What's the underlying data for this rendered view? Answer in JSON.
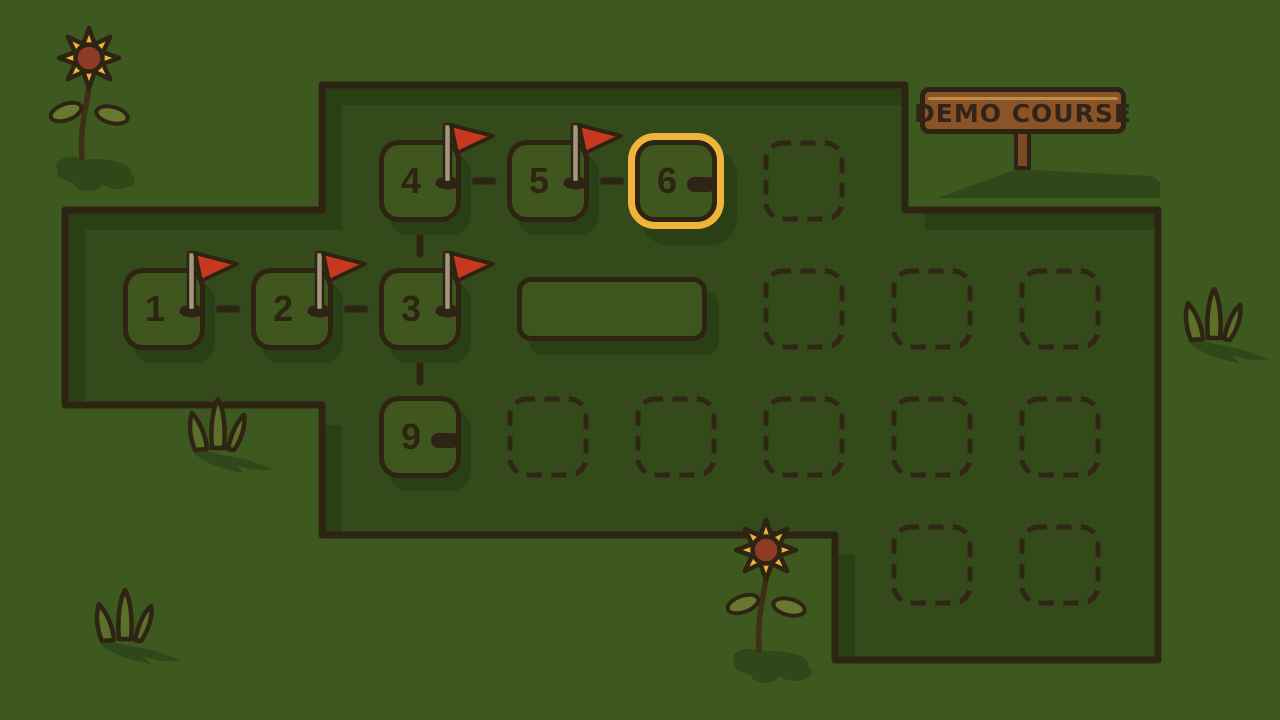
{
  "sign": {
    "label": "DEMO COURSE"
  },
  "course": {
    "levels": [
      {
        "label": "1",
        "col": 0,
        "row": 1,
        "flag": true,
        "selected": false,
        "score": null
      },
      {
        "label": "2",
        "col": 1,
        "row": 1,
        "flag": true,
        "selected": false,
        "score": null
      },
      {
        "label": "3",
        "col": 2,
        "row": 1,
        "flag": true,
        "selected": false,
        "score": null
      },
      {
        "label": "4",
        "col": 2,
        "row": 0,
        "flag": true,
        "selected": false,
        "score": null
      },
      {
        "label": "5",
        "col": 3,
        "row": 0,
        "flag": true,
        "selected": false,
        "score": null
      },
      {
        "label": "6",
        "col": 4,
        "row": 0,
        "flag": false,
        "selected": true,
        "score": "-"
      },
      {
        "label": "9",
        "col": 2,
        "row": 2,
        "flag": false,
        "selected": false,
        "score": "-"
      }
    ],
    "empty_slots": [
      {
        "col": 5,
        "row": 0
      },
      {
        "col": 5,
        "row": 1
      },
      {
        "col": 6,
        "row": 1
      },
      {
        "col": 7,
        "row": 1
      },
      {
        "col": 3,
        "row": 2
      },
      {
        "col": 4,
        "row": 2
      },
      {
        "col": 5,
        "row": 2
      },
      {
        "col": 6,
        "row": 2
      },
      {
        "col": 7,
        "row": 2
      },
      {
        "col": 6,
        "row": 3
      },
      {
        "col": 7,
        "row": 3
      }
    ],
    "wide_tile": {
      "row": 1,
      "col_start": 3
    },
    "connectors": [
      {
        "dir": "h",
        "row": 1,
        "after_col": 0
      },
      {
        "dir": "h",
        "row": 1,
        "after_col": 1
      },
      {
        "dir": "h",
        "row": 0,
        "after_col": 2
      },
      {
        "dir": "h",
        "row": 0,
        "after_col": 3
      },
      {
        "dir": "v",
        "col": 2,
        "after_row": 0
      },
      {
        "dir": "v",
        "col": 2,
        "after_row": 1
      }
    ]
  },
  "decorations": {
    "sunflowers": [
      {
        "x": 26,
        "y": 20
      },
      {
        "x": 703,
        "y": 512
      }
    ],
    "grass_tufts": [
      {
        "x": 83,
        "y": 583
      },
      {
        "x": 176,
        "y": 392
      },
      {
        "x": 1172,
        "y": 282
      }
    ]
  },
  "colors": {
    "background": "#3E5920",
    "panel": "#344A1B",
    "shadow": "#2B3F15",
    "tile": "#3F571F",
    "wide_tile": "#3D551F",
    "outline": "#2E2413",
    "slot_dash": "#302617",
    "ring": "#F0B43B",
    "flag_red": "#C8381F",
    "pole": "#A4977F",
    "sign_board": "#8A5426",
    "sign_line": "#BE8B48",
    "sign_post": "#7B4A22",
    "sign_text": "#31241A",
    "petal": "#F0B43B",
    "flower_disk": "#8C3B24",
    "leaf": "#68792F",
    "grass_blade": "#5C7029",
    "ground_shadow": "#2F4719",
    "stem": "#3F2E18"
  }
}
